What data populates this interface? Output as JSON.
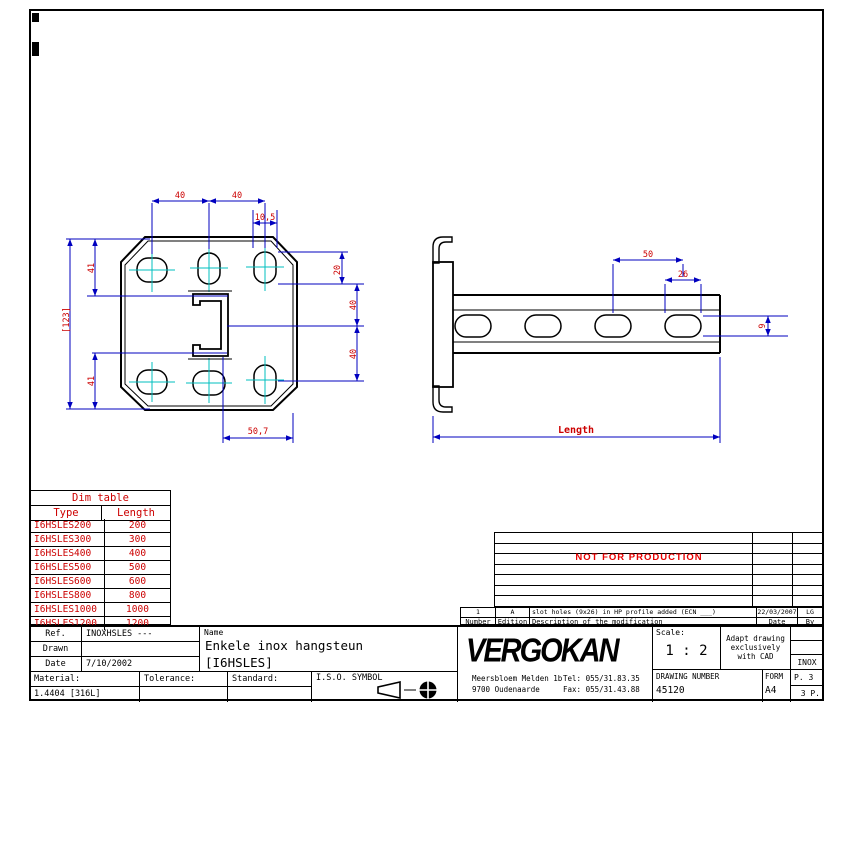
{
  "plate_view": {
    "dims": {
      "top_span1": "40",
      "top_span2": "40",
      "slot_width": "10,5",
      "overall_height": "[123]",
      "left_top": "41",
      "left_bottom": "41",
      "right_top": "20",
      "right_mid": "40",
      "right_bottom": "40",
      "bottom": "50,7"
    }
  },
  "rail_view": {
    "dims": {
      "pitch": "50",
      "slot_length": "26",
      "slot_height": "9",
      "length": "Length"
    }
  },
  "dim_table": {
    "title": "Dim table",
    "col_type": "Type",
    "col_length": "Length",
    "rows": [
      {
        "type": "I6HSLES200",
        "length": "200"
      },
      {
        "type": "I6HSLES300",
        "length": "300"
      },
      {
        "type": "I6HSLES400",
        "length": "400"
      },
      {
        "type": "I6HSLES500",
        "length": "500"
      },
      {
        "type": "I6HSLES600",
        "length": "600"
      },
      {
        "type": "I6HSLES800",
        "length": "800"
      },
      {
        "type": "I6HSLES1000",
        "length": "1000"
      },
      {
        "type": "I6HSLES1200",
        "length": "1200"
      }
    ]
  },
  "mod_table": {
    "watermark": "NOT FOR PRODUCTION",
    "entry": {
      "number": "1",
      "edition": "A",
      "description": "slot holes (9x26) in HP profile added (ECN ___)",
      "date": "22/03/2007",
      "by": "LG"
    },
    "headers": {
      "number": "Number",
      "edition": "Edition",
      "description": "Description of the modification",
      "date": "Date",
      "by": "By"
    }
  },
  "title_block": {
    "ref_label": "Ref.",
    "ref_value": "INOXHSLES ---",
    "drawn_label": "Drawn",
    "drawn_value": "",
    "date_label": "Date",
    "date_value": "7/10/2002",
    "name_label": "Name",
    "name_line1": "Enkele inox hangsteun",
    "name_line2": "[I6HSLES]",
    "material_label": "Material:",
    "material_value": "1.4404 [316L]",
    "tolerance_label": "Tolerance:",
    "tolerance_value": "",
    "standard_label": "Standard:",
    "standard_value": "",
    "iso_label": "I.S.O. SYMBOL",
    "company": {
      "logo": "VERGOKAN",
      "address1": "Meersbloem Melden 1b",
      "address2": "9700 Oudenaarde",
      "tel": "Tel: 055/31.83.35",
      "fax": "Fax: 055/31.43.88"
    },
    "scale_label": "Scale:",
    "scale_value": "1 : 2",
    "cad_note_line1": "Adapt drawing",
    "cad_note_line2": "exclusively",
    "cad_note_line3": "with CAD",
    "inox_value": "INOX",
    "drawing_number_label": "DRAWING NUMBER",
    "drawing_number": "45120",
    "form_label": "FORM",
    "form_value": "A4",
    "page": "P. 3",
    "pages": "3 P."
  },
  "colors": {
    "dimension_line": "#0000bf",
    "dimension_text": "#cc0000",
    "centerline": "#00bfbf",
    "warning_text": "#e60000",
    "geometry": "#000000"
  }
}
